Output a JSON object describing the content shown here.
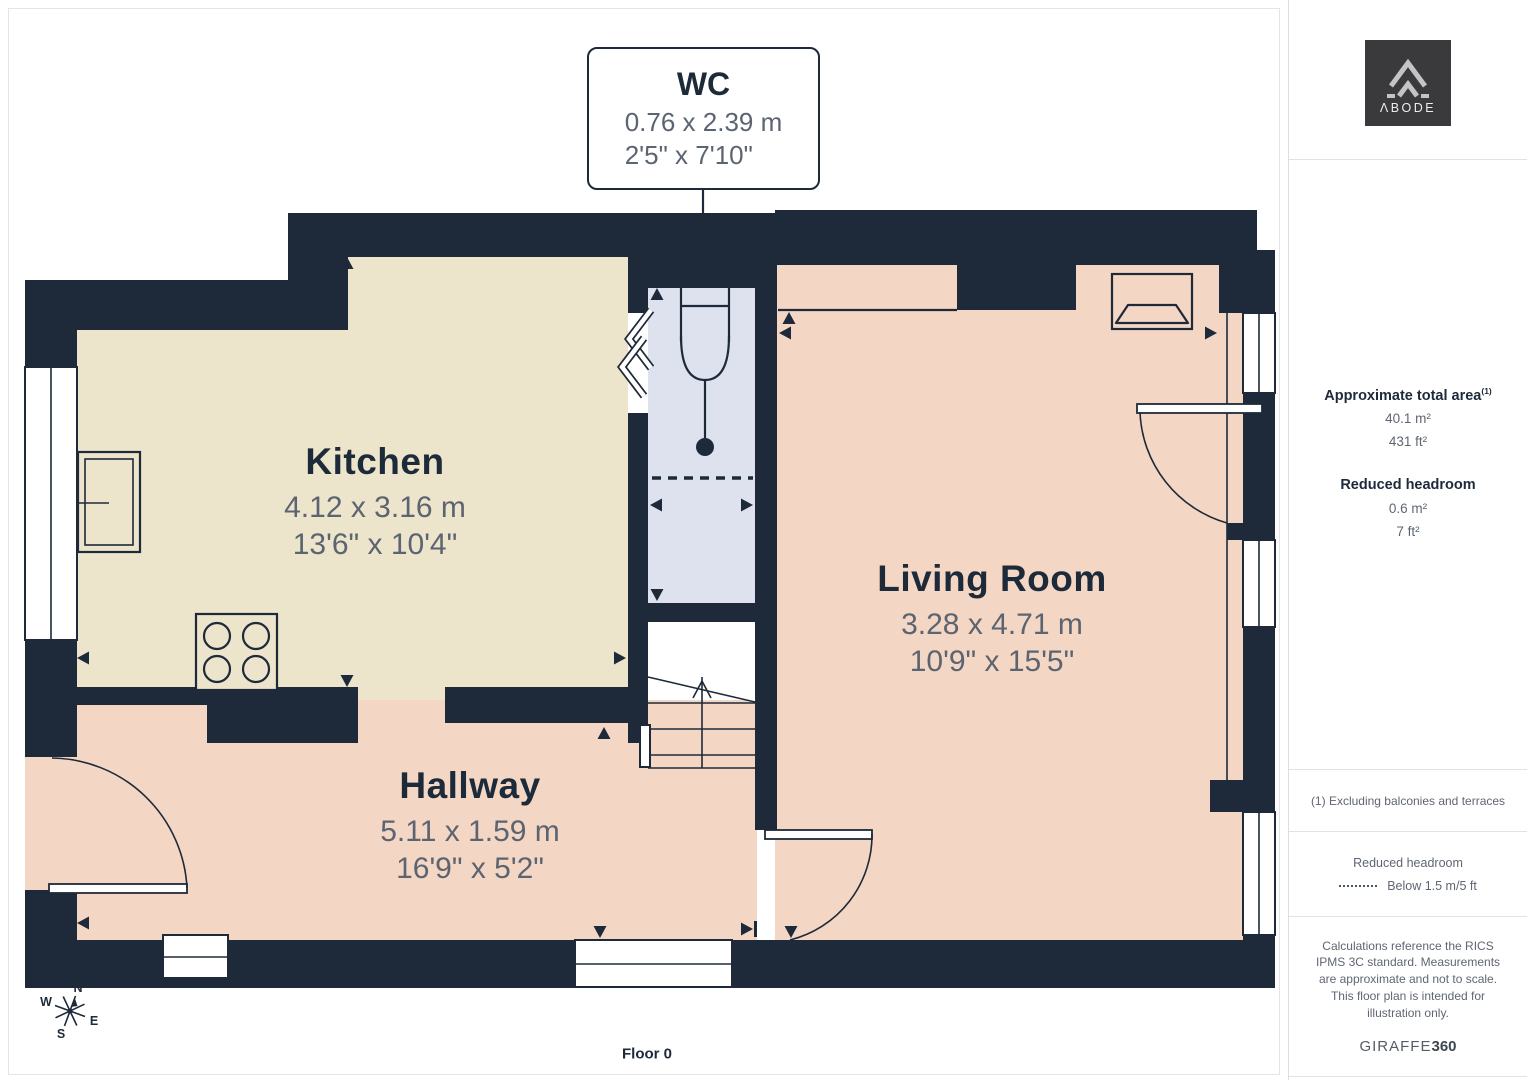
{
  "page": {
    "floor_label": "Floor 0"
  },
  "colors": {
    "c-wall": "#1e2a3a",
    "c-kitchen": "#ece4cb",
    "c-living": "#f3d6c3",
    "c-wc": "#dde2ee",
    "c-title": "#1d2a3a",
    "c-dim": "#5b6470",
    "c-logo": "#3a3a3c"
  },
  "rooms": [
    {
      "name": "Kitchen",
      "dim_m": "4.12 x 3.16 m",
      "dim_ft": "13'6\" x 10'4\""
    },
    {
      "name": "Living Room",
      "dim_m": "3.28 x 4.71 m",
      "dim_ft": "10'9\" x 15'5\""
    },
    {
      "name": "Hallway",
      "dim_m": "5.11 x 1.59 m",
      "dim_ft": "16'9\" x 5'2\""
    },
    {
      "name": "WC",
      "dim_m": "0.76 x 2.39 m",
      "dim_ft": "2'5\" x 7'10\""
    }
  ],
  "compass": {
    "n": "N",
    "e": "E",
    "s": "S",
    "w": "W"
  },
  "sidebar": {
    "logo_text": "ΛBODE",
    "area_title": "Approximate total area",
    "area_sup": "(1)",
    "area_m2": "40.1 m²",
    "area_ft2": "431 ft²",
    "headroom_title": "Reduced headroom",
    "headroom_m2": "0.6 m²",
    "headroom_ft2": "7 ft²",
    "footnote": "(1) Excluding balconies and terraces",
    "legend_title": "Reduced headroom",
    "legend_value": "Below 1.5 m/5 ft",
    "disclaimer": "Calculations reference the RICS IPMS 3C standard. Measurements are approximate and not to scale. This floor plan is intended for illustration only.",
    "brand": "GIRAFFE",
    "brand_bold": "360"
  }
}
